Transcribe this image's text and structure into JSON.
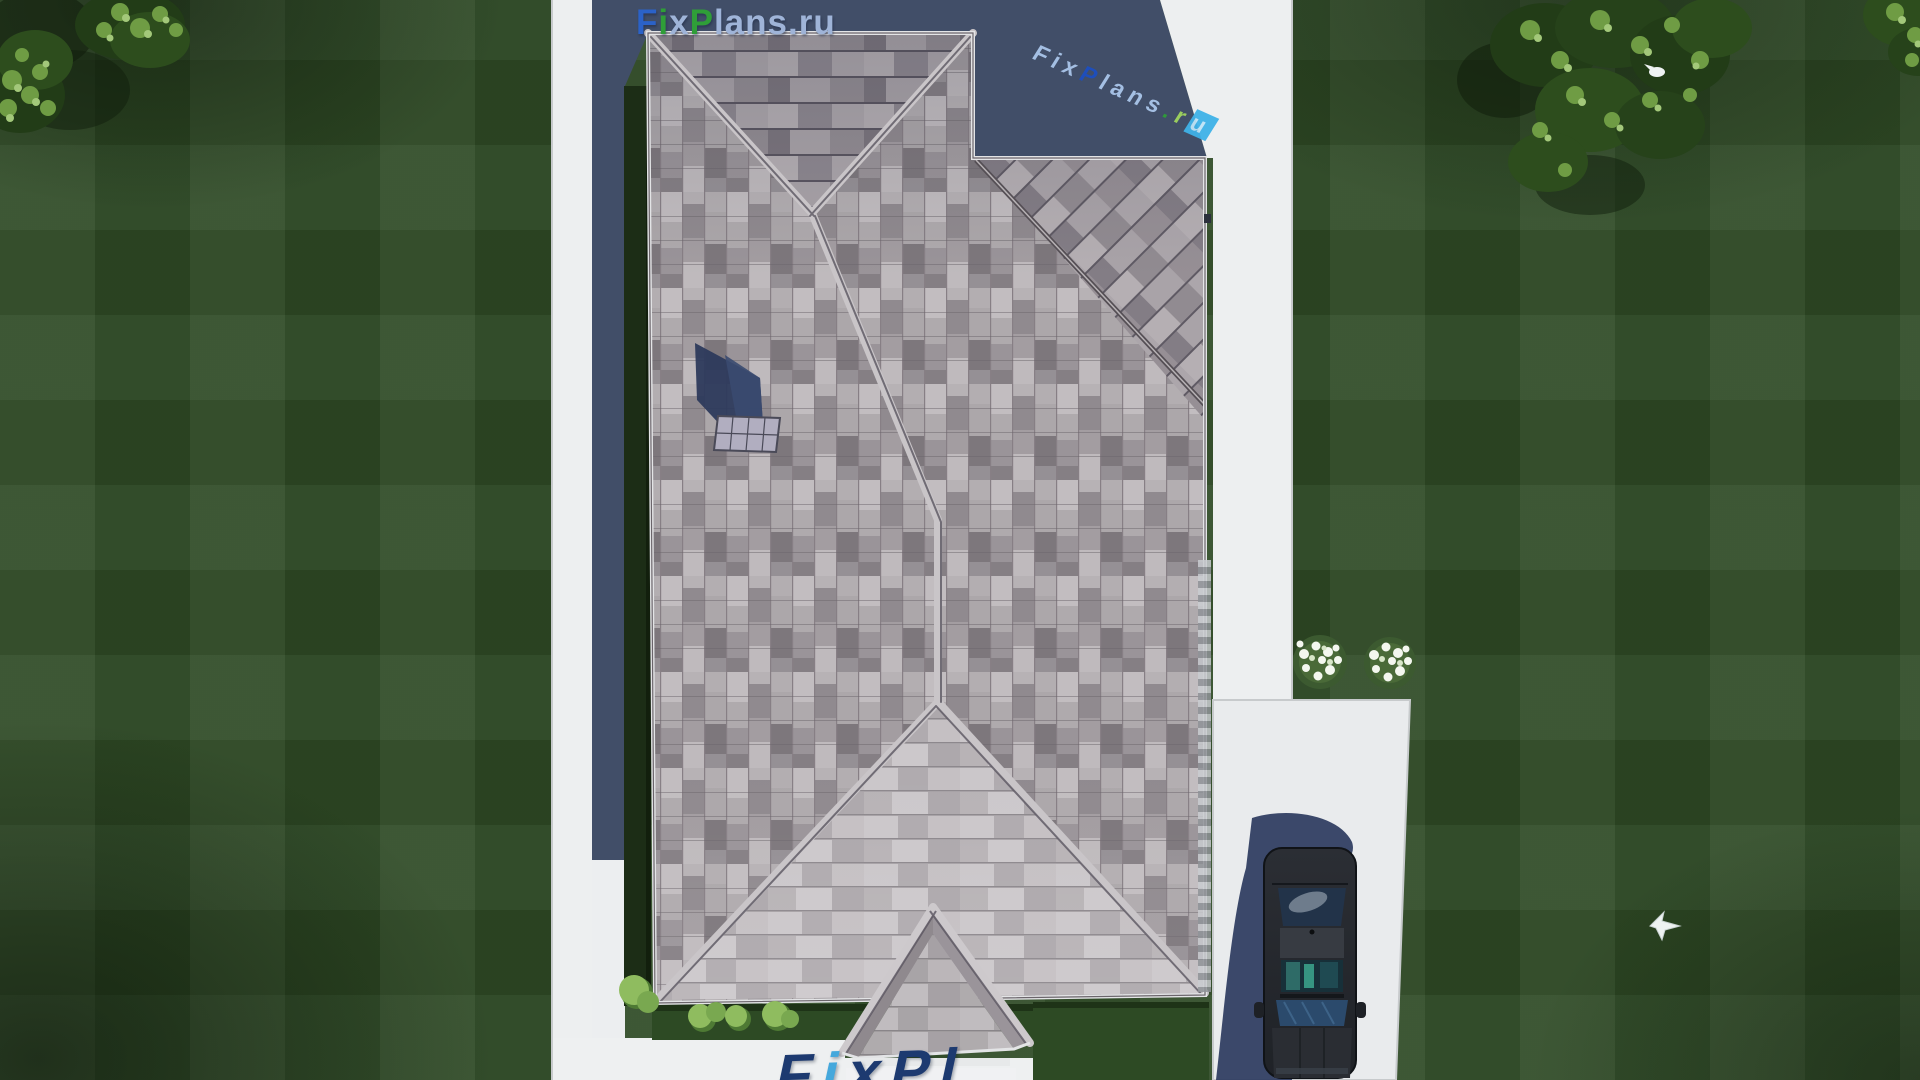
{
  "scene": {
    "title": "Aerial top-down 3D render of a single-family house roof plan",
    "colors": {
      "lawn": "#2e4a25",
      "path_white": "#edeff0",
      "house_shadow_blue": "#414e68",
      "hedge_green": "#1c2d16",
      "roof_light": "#c3bec1",
      "roof_mid": "#a7a1a5",
      "roof_dark": "#837d81",
      "car_body": "#25282e",
      "car_shadow": "#2b3a5e",
      "flower_white": "#f4f7ef",
      "logo_blue": "#2b62c8",
      "logo_green": "#2f9e38",
      "logo_light_blue": "#9fb4d8"
    },
    "objects": [
      "gray shingled hip roof with cross gable",
      "skylight with shadow on west slope",
      "front porch gable with steps",
      "white perimeter walkways",
      "driveway with parked dark sedan",
      "white flower bushes",
      "hedges and light-green shrubs",
      "trees in top corners",
      "white bird flying over lawn",
      "white bird in tree"
    ]
  },
  "watermarks": {
    "top": {
      "f": "F",
      "i": "i",
      "x": "x",
      "p": "P",
      "rest": "lans.ru"
    },
    "diagonal": {
      "pre": "Fix",
      "p": "P",
      "mid": "lans",
      "dot": ".",
      "r": "r",
      "u": "u"
    },
    "bottom": {
      "f": "F",
      "i": "i",
      "rest": "xPl"
    }
  }
}
